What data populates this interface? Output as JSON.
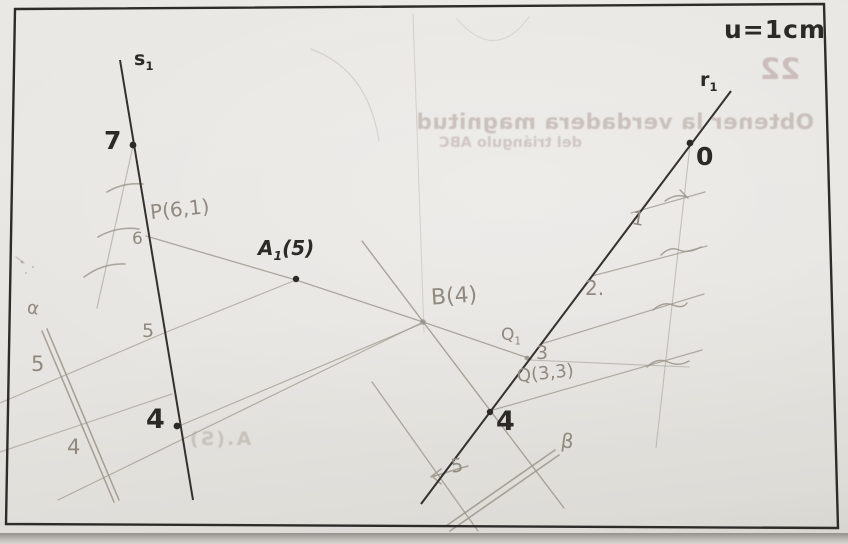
{
  "unit_note": "u=1cm",
  "labels": {
    "s1": {
      "main": "s",
      "sub": "1"
    },
    "r1": {
      "main": "r",
      "sub": "1"
    },
    "a1": {
      "main": "A",
      "sub": "1",
      "rest": "(5)"
    },
    "q1": {
      "main": "Q",
      "sub": "1"
    },
    "seven": "7",
    "zero": "0",
    "four_s1": "4",
    "four_r1": "4",
    "p_point": "P(6,1)",
    "six": "6",
    "five_s1": "5",
    "five_left": "5",
    "four_left": "4",
    "alpha": "α",
    "b_point": "B(4)",
    "three": "3",
    "q_point": "Q(3,3)",
    "two": "2.",
    "one": "1",
    "five_r1": "5",
    "beta": "β"
  },
  "bleed": {
    "number": "22",
    "line1": "Obtener la verdadera magnitud",
    "line2": "del triángulo ABC",
    "note": "A.(S)"
  }
}
